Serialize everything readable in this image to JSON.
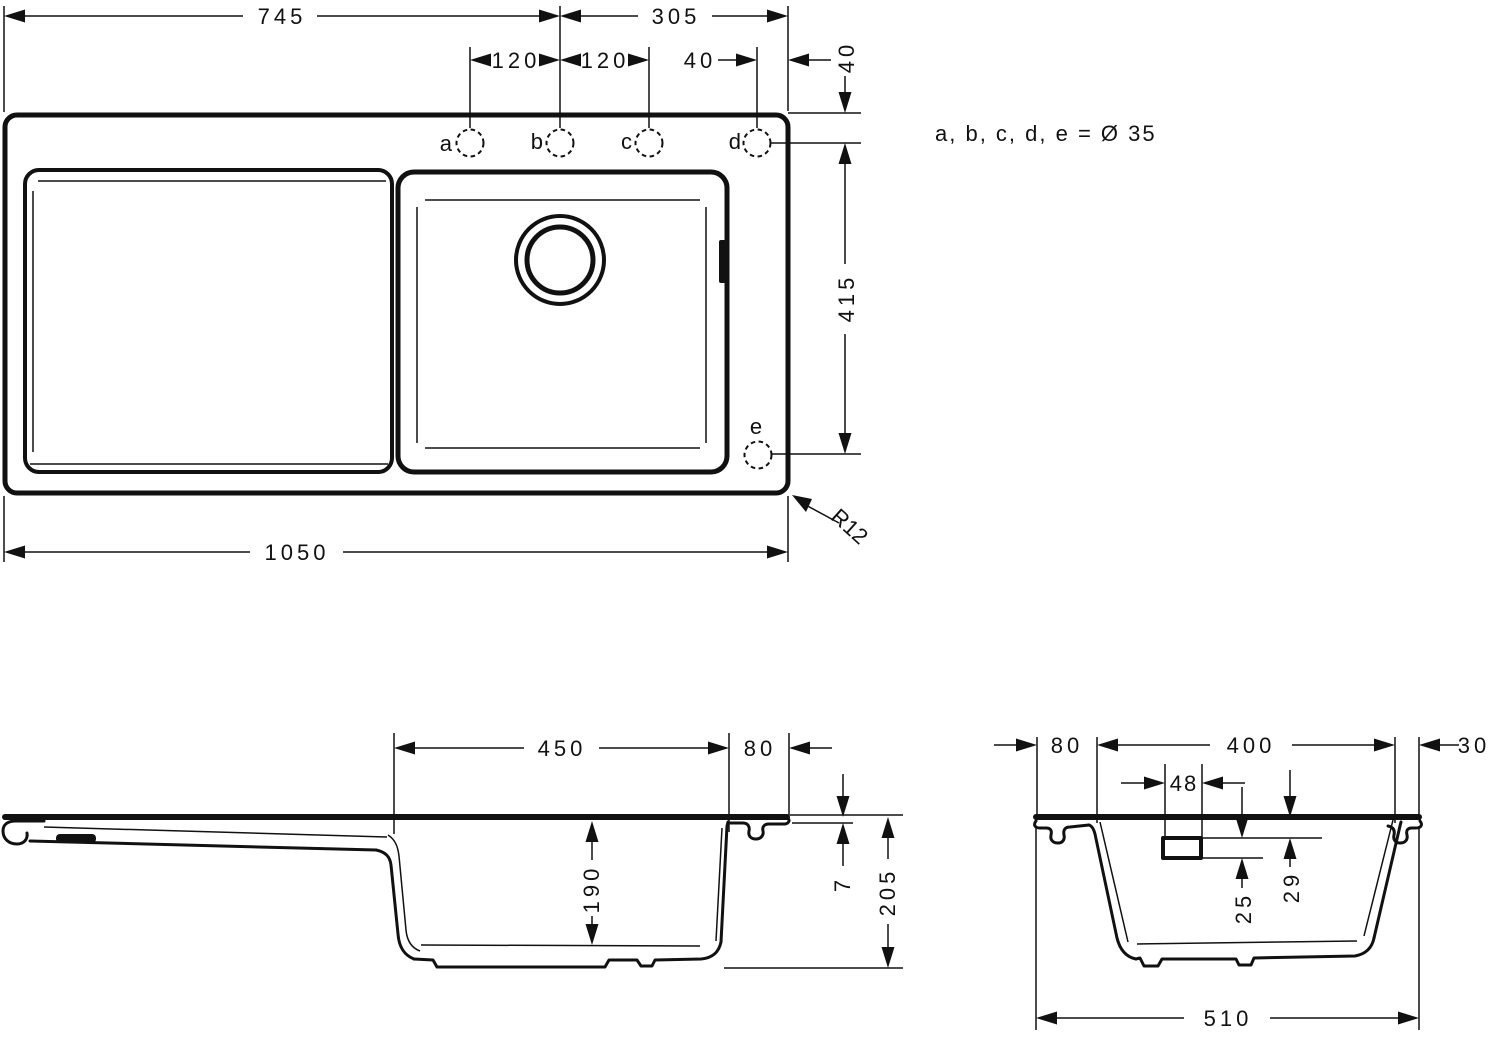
{
  "note": "a, b, c, d, e = Ø 35",
  "top_view": {
    "holes": {
      "a": "a",
      "b": "b",
      "c": "c",
      "d": "d",
      "e": "e"
    },
    "dims": {
      "span_left": "745",
      "span_right": "305",
      "pitch_ab": "120",
      "pitch_bc": "120",
      "d_to_edge": "40",
      "top_to_holes": "40",
      "holes_to_e": "415",
      "overall_width": "1050",
      "corner_radius": "R12"
    }
  },
  "front_section": {
    "dims": {
      "bowl_width": "450",
      "rim_right": "80",
      "bowl_depth": "190",
      "rim_thickness": "7",
      "overall_height": "205"
    }
  },
  "side_section": {
    "dims": {
      "rim_left": "80",
      "bowl_width": "400",
      "rim_right": "30",
      "overflow_width": "48",
      "overflow_height": "25",
      "overflow_offset": "29",
      "overall_depth": "510"
    }
  }
}
